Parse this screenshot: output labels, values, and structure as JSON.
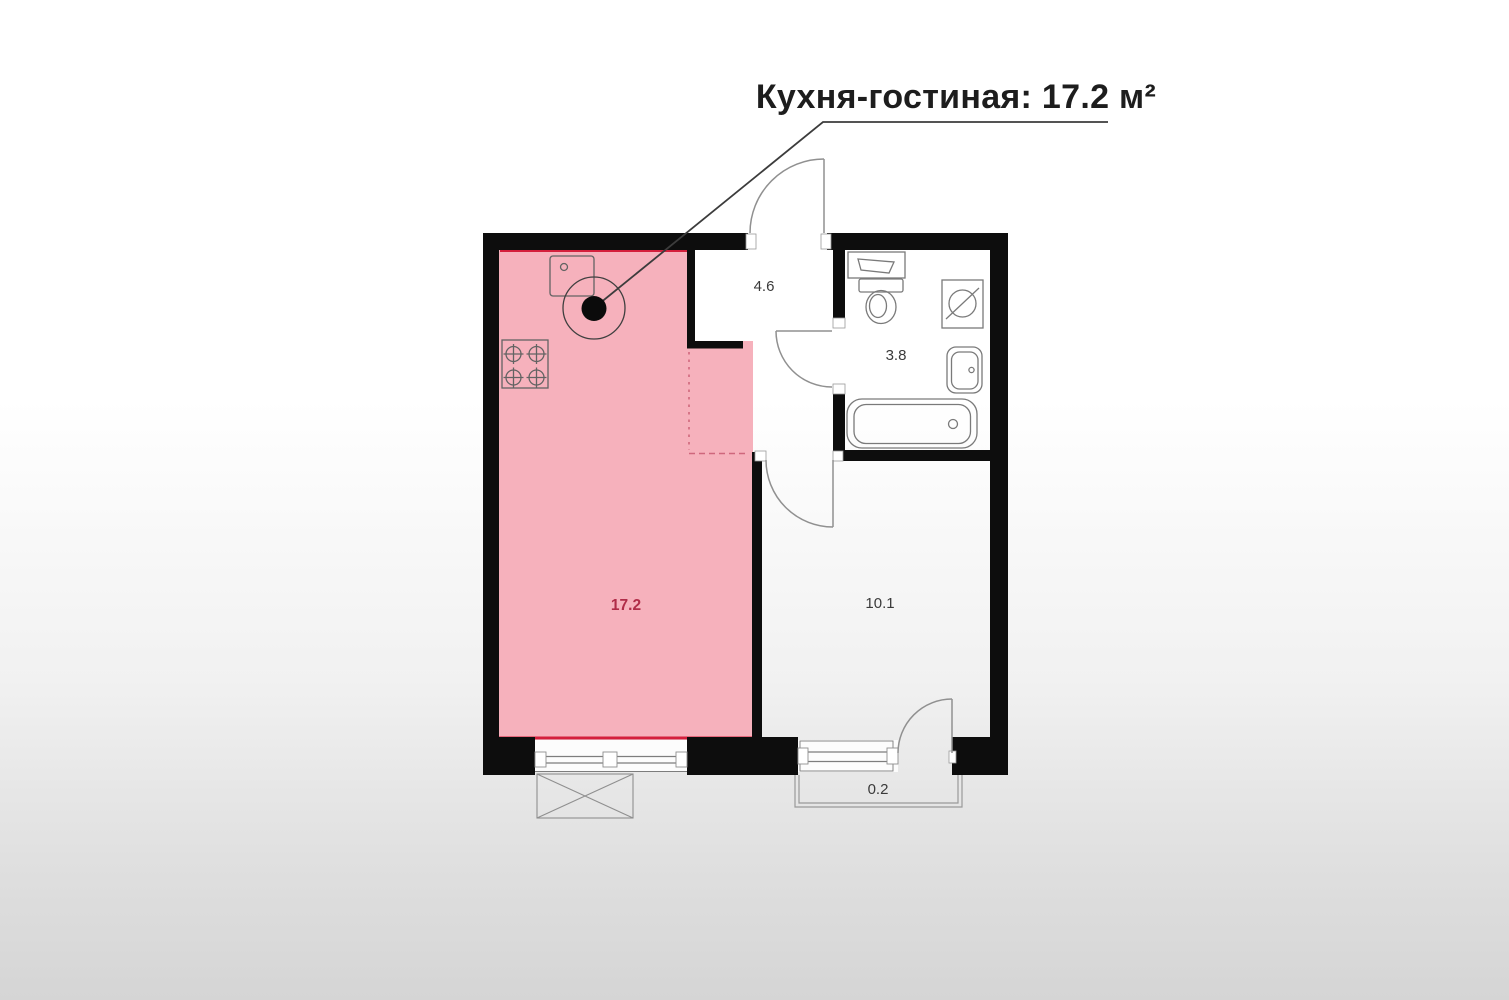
{
  "annotation": {
    "title": "Кухня-гостиная: 17.2 м²"
  },
  "plan": {
    "rooms": [
      {
        "name": "kitchen-living-room",
        "area_label": "17.2",
        "highlighted": true
      },
      {
        "name": "hallway",
        "area_label": "4.6",
        "highlighted": false
      },
      {
        "name": "bathroom",
        "area_label": "3.8",
        "highlighted": false
      },
      {
        "name": "room",
        "area_label": "10.1",
        "highlighted": false
      },
      {
        "name": "balcony",
        "area_label": "0.2",
        "highlighted": false
      }
    ],
    "fixtures": [
      "kitchen-sink",
      "stove",
      "point-marker",
      "toilet",
      "bathroom-sink",
      "washing-machine",
      "wash-basin",
      "bathtub",
      "air-conditioner",
      "windows",
      "door-arcs"
    ]
  },
  "colors": {
    "highlight_fill": "#f6b1bc",
    "highlight_accent": "#d41f3c",
    "highlight_label": "#b02c48",
    "wall": "#0d0d0d",
    "fixture_line": "#636363",
    "bath_fixture_line": "#7a7a7a",
    "door_line": "#909090",
    "window_line": "#7d7d7d",
    "balcony_line": "#9a9a9a",
    "room_label": "#3a3a3a",
    "leader_line": "#3c3c3c",
    "title_text": "#1d1d1d"
  }
}
